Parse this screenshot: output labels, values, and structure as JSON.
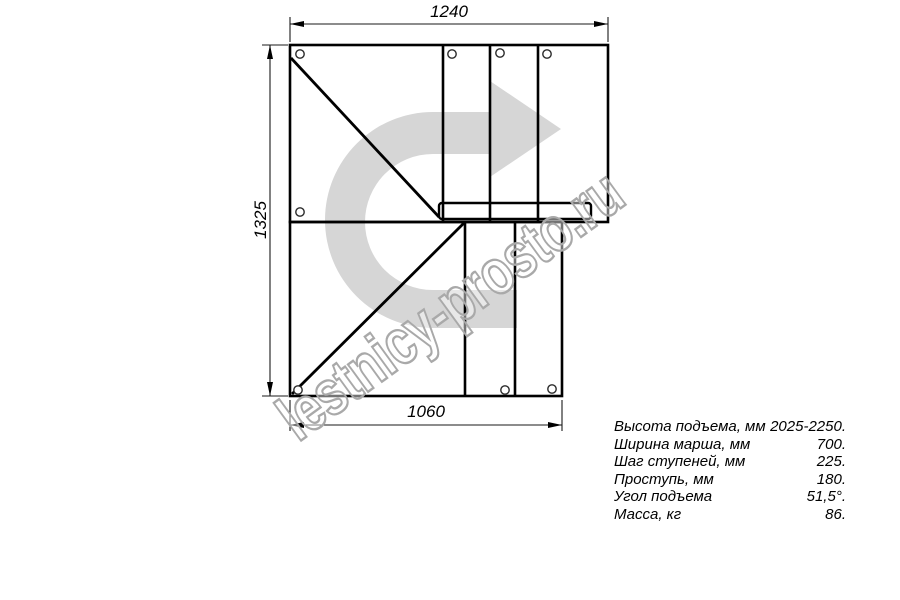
{
  "drawing": {
    "type": "stair-plan-top-view",
    "line_color": "#000000",
    "background": "#ffffff"
  },
  "dimensions": {
    "top_mm": "1240",
    "left_mm": "1325",
    "bottom_mm": "1060"
  },
  "specs": {
    "rows": [
      {
        "label": "Высота подъема, мм",
        "value": "2025-2250."
      },
      {
        "label": "Ширина марша, мм",
        "value": "700."
      },
      {
        "label": "Шаг ступеней, мм",
        "value": "225."
      },
      {
        "label": "Проступь, мм",
        "value": "180."
      },
      {
        "label": "Угол подъема",
        "value": "51,5°."
      },
      {
        "label": "Масса, кг",
        "value": "86."
      }
    ]
  },
  "watermark": {
    "text": "lestnicy-prosto.ru",
    "arrow_icon": "u-turn-right-arrow",
    "arrow_color": "#d6d6d6",
    "text_stroke_color": "#a9a9a9"
  }
}
